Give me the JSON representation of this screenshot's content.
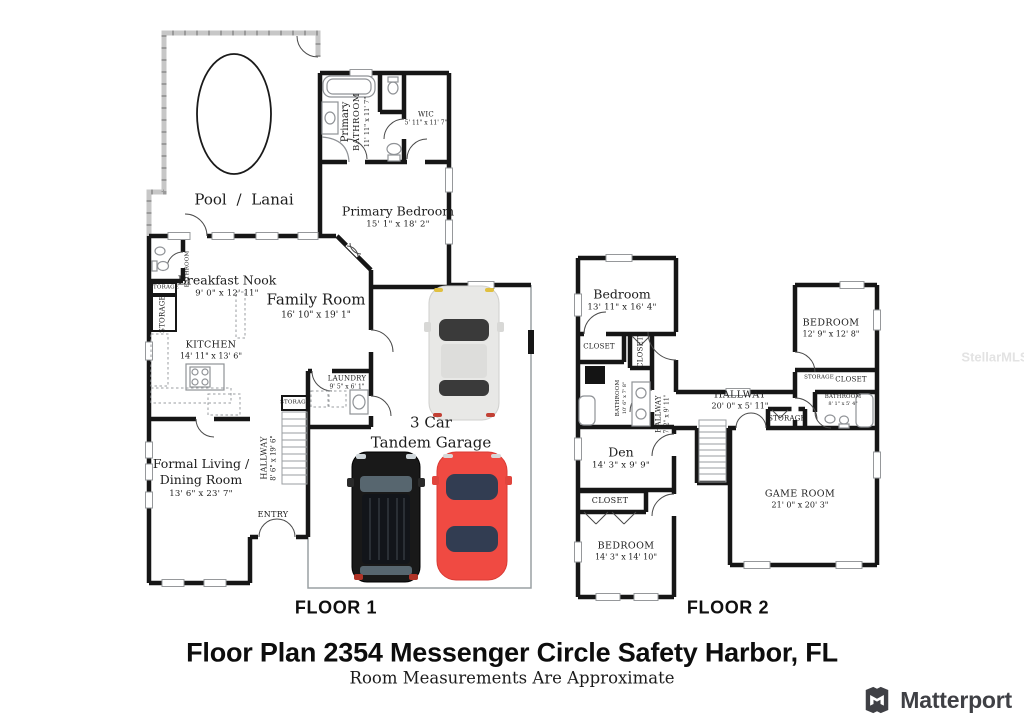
{
  "watermark": "StellarMLS",
  "footer": {
    "title": "Floor Plan 2354 Messenger Circle Safety Harbor, FL",
    "subtitle": "Room Measurements Are Approximate",
    "brand": "Matterport"
  },
  "colors": {
    "wall": "#161616",
    "screen_wall": "#c7c7c7",
    "car_white": "#e8e8e6",
    "car_black": "#191919",
    "car_red": "#f04a42"
  },
  "floor1": {
    "caption": "FLOOR 1",
    "rooms": {
      "pool": {
        "name": "Pool / Lanai"
      },
      "primary_bathroom": {
        "name": "Primary",
        "name2": "BATHROOM",
        "dims": "11' 11\" x 11' 7\""
      },
      "wic": {
        "name": "WIC",
        "dims": "5' 11\" x 11' 7\""
      },
      "primary_bedroom": {
        "name": "Primary Bedroom",
        "dims": "15' 1\" x 18' 2\""
      },
      "breakfast_nook": {
        "name": "Breakfast Nook",
        "dims": "9' 0\" x 12' 11\""
      },
      "family_room": {
        "name": "Family Room",
        "dims": "16' 10\" x 19' 1\""
      },
      "kitchen": {
        "name": "KITCHEN",
        "dims": "14' 11\" x 13' 6\""
      },
      "laundry": {
        "name": "LAUNDRY",
        "dims": "9' 5\" x 6' 1\""
      },
      "bathroom": {
        "name": "BATHROOM"
      },
      "storage_small": {
        "name": "STORAGE"
      },
      "storage_tall": {
        "name": "STORAGE"
      },
      "storage_stairs": {
        "name": "STORAGE"
      },
      "hallway": {
        "name": "HALLWAY",
        "dims": "8' 6\" x 19' 6\""
      },
      "formal_living": {
        "name": "Formal Living / Dining Room",
        "dims": "13' 6\" x 23' 7\""
      },
      "entry": {
        "name": "ENTRY"
      },
      "garage": {
        "name": "3 Car",
        "name2": "Tandem Garage"
      }
    }
  },
  "floor2": {
    "caption": "FLOOR 2",
    "rooms": {
      "bedroom1": {
        "name": "Bedroom",
        "dims": "13' 11\" x 16' 4\""
      },
      "closet1": {
        "name": "CLOSET"
      },
      "closet2": {
        "name": "CLOSET"
      },
      "bathroom_left": {
        "name": "BATHROOM",
        "dims": "10' 6\" x 7' 8\""
      },
      "hallway_small": {
        "name": "HALLWAY",
        "dims": "7' 2\" x 9' 11\""
      },
      "hallway": {
        "name": "HALLWAY",
        "dims": "20' 0\" x 5' 11\""
      },
      "bedroom2": {
        "name": "BEDROOM",
        "dims": "12' 9\" x 12' 8\""
      },
      "storage_small": {
        "name": "STORAGE"
      },
      "closet3": {
        "name": "CLOSET"
      },
      "bathroom_right": {
        "name": "BATHROOM",
        "dims": "8' 1\" x 5' 4\""
      },
      "storage_hall": {
        "name": "STORAGE"
      },
      "den": {
        "name": "Den",
        "dims": "14' 3\" x 9' 9\""
      },
      "closet4": {
        "name": "CLOSET"
      },
      "bedroom3": {
        "name": "BEDROOM",
        "dims": "14' 3\" x 14' 10\""
      },
      "game_room": {
        "name": "GAME ROOM",
        "dims": "21' 0\" x 20' 3\""
      }
    }
  }
}
